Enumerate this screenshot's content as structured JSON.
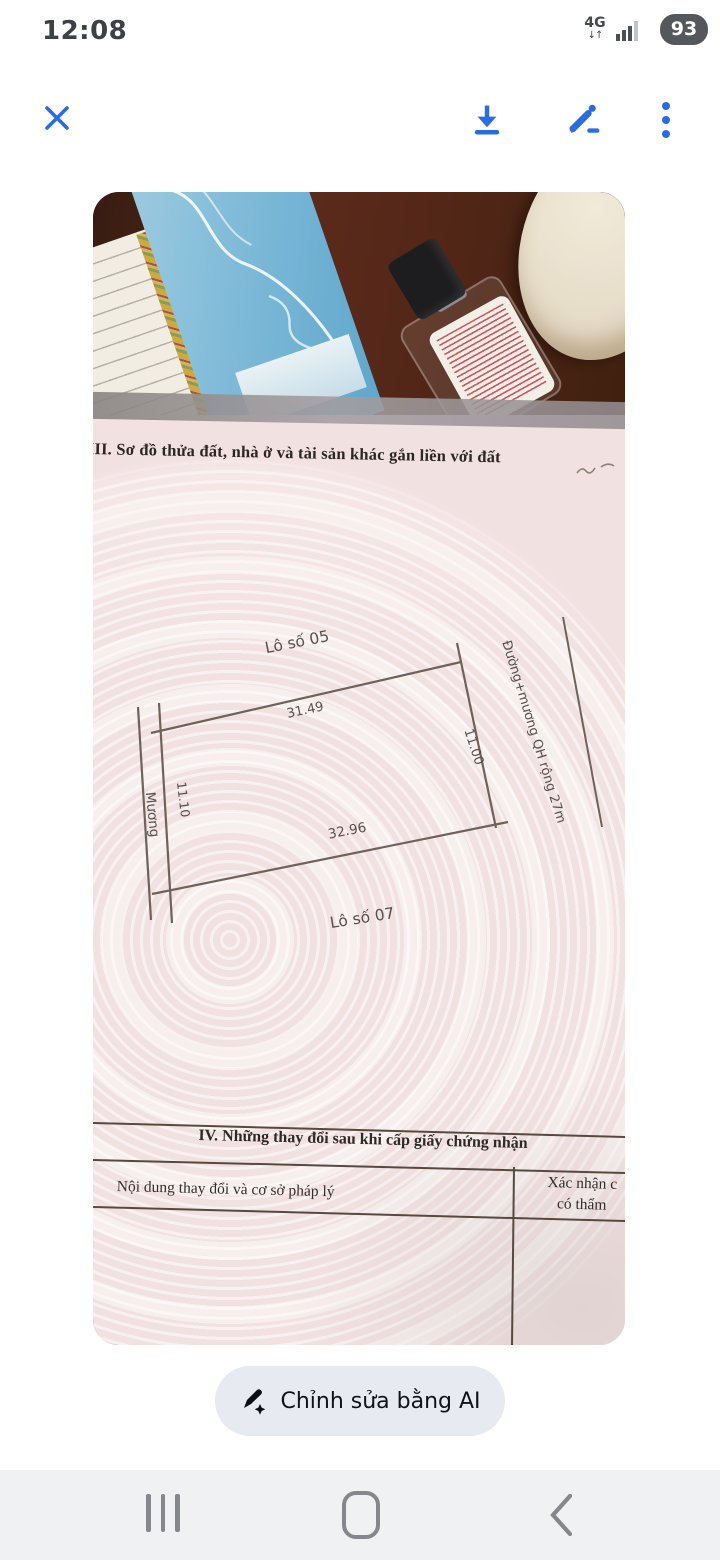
{
  "status_bar": {
    "time": "12:08",
    "network": "4G",
    "battery": "93"
  },
  "photo": {
    "document": {
      "section3_title": "III. Sơ đồ thửa đất, nhà ở và tài sản khác gắn liền với đất",
      "map": {
        "lot_05": "Lô số 05",
        "lot_07": "Lô số 07",
        "edge_top": "31.49",
        "edge_right": "11.00",
        "edge_bottom": "32.96",
        "edge_left": "11.10",
        "canal": "Mương",
        "road": "Đường+mương QH rộng 27m"
      },
      "section4_title": "IV. Những thay đổi sau khi cấp giấy chứng nhận",
      "table": {
        "col_content": "Nội dung thay đổi và cơ sở pháp lý",
        "col_confirm_line1": "Xác nhận c",
        "col_confirm_line2": "có thẩm"
      }
    }
  },
  "ai_button": {
    "label": "Chỉnh sửa bằng AI"
  },
  "colors": {
    "accent_blue": "#2b6be3",
    "document_pink": "#f2e1e1",
    "battery_pill": "#54575c",
    "button_bg": "#e8eaf1"
  }
}
